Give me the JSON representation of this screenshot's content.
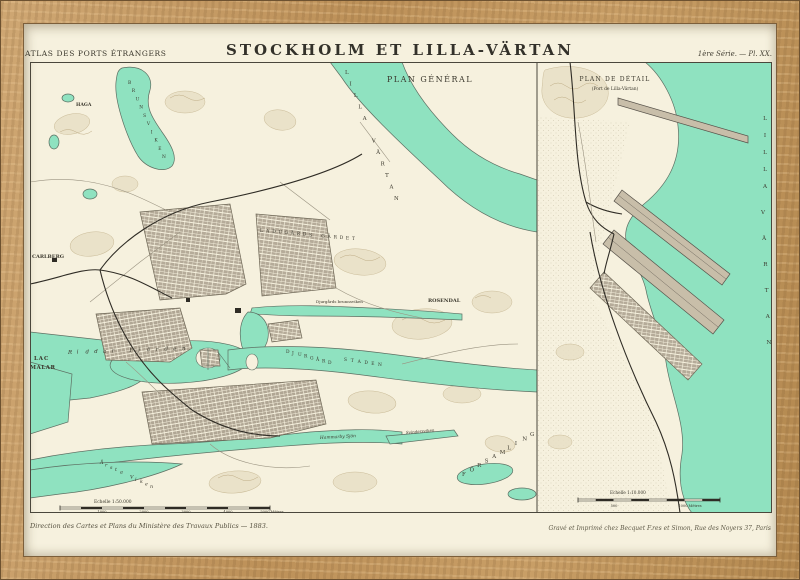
{
  "palette": {
    "frame_wood": "#c59a63",
    "paper": "#f6f1de",
    "water": "#8fe2c0",
    "ink": "#3a372c"
  },
  "header": {
    "series_label": "ATLAS DES PORTS ÉTRANGERS",
    "title": "STOCKHOLM ET LILLA-VÄRTAN",
    "plate_label": "1ère Série. — Pl. XX."
  },
  "main_map": {
    "title": "PLAN GÉNÉRAL",
    "scale_label": "Echelle 1:50.000",
    "scale_ticks": [
      "1000",
      "2000",
      "3000",
      "4000",
      "5000 Mètres"
    ],
    "labels": {
      "haga": "HAGA",
      "brunsviken": "BRUNSVIKEN",
      "carlberg": "CARLBERG",
      "ladugards_gardet": "LADUGÅRDS GÄRDET",
      "lilla_vartan": "LILLA VÄRTAN",
      "djurgards_brunnsviken": "Djurgårds brunnsviken",
      "rosendal": "ROSENDAL",
      "djurgard": "DJURGÅRD",
      "staden": "STADEN",
      "riddar_fjarden": "Riddar Fjärden",
      "lac_line1": "LAC",
      "lac_line2": "MALAR",
      "arsta_viken": "Årsta Viken",
      "hammarby_sjon": "Hammarby Sjön",
      "svindersviken": "Svindersviken",
      "forsamling": "FÖRSAMLING"
    }
  },
  "detail_map": {
    "title": "PLAN DE DÉTAIL",
    "subtitle": "(Port de Lilla-Värtan)",
    "sea_label_1": "LILLA",
    "sea_label_2": "VÄRTAN",
    "scale_label": "Echelle 1:10.000",
    "scale_ticks": [
      "500",
      "1000 Mètres"
    ]
  },
  "footer": {
    "left": "Direction des Cartes et Plans du Ministère des Travaux Publics — 1883.",
    "right": "Gravé et Imprimé chez Becquet F.res et Simon, Rue des Noyers 37, Paris"
  }
}
